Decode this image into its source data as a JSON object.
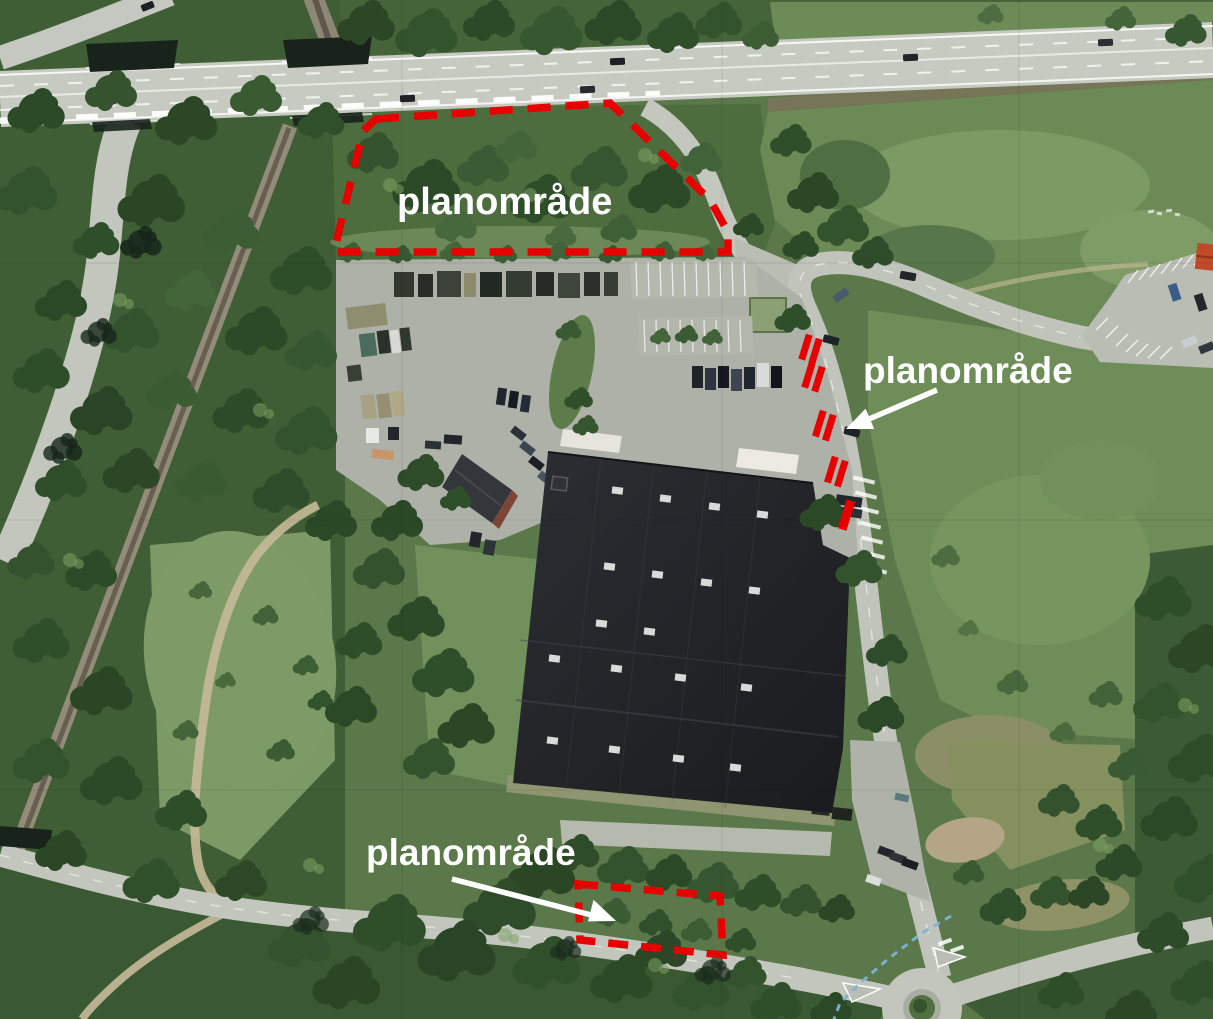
{
  "map": {
    "labels": [
      {
        "id": "planomrade-top",
        "text": "planområde"
      },
      {
        "id": "planomrade-right",
        "text": "planområde"
      },
      {
        "id": "planomrade-bottom",
        "text": "planområde"
      }
    ],
    "colors": {
      "boundary": "#e60000",
      "label_text": "#ffffff",
      "guide_line": "#7fb2d6"
    }
  }
}
